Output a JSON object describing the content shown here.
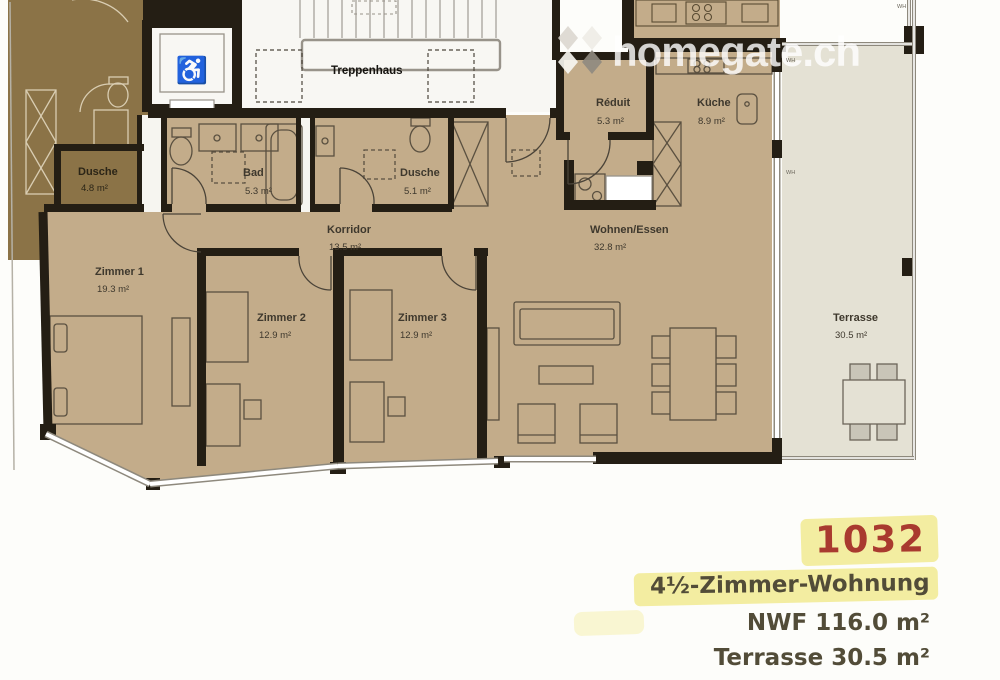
{
  "watermark": {
    "text": "homegate.ch",
    "icon": "homegate-diamond-logo"
  },
  "rooms": {
    "treppenhaus": {
      "name": "Treppenhaus"
    },
    "dusche_nachbar": {
      "name": "Dusche",
      "area": "4.8 m²"
    },
    "bad": {
      "name": "Bad",
      "area": "5.3 m²"
    },
    "dusche": {
      "name": "Dusche",
      "area": "5.1 m²"
    },
    "reduit": {
      "name": "Réduit",
      "area": "5.3 m²"
    },
    "kueche": {
      "name": "Küche",
      "area": "8.9 m²"
    },
    "korridor": {
      "name": "Korridor",
      "area": "13.5 m²"
    },
    "wohnen_essen": {
      "name": "Wohnen/Essen",
      "area": "32.8 m²"
    },
    "zimmer1": {
      "name": "Zimmer 1",
      "area": "19.3 m²"
    },
    "zimmer2": {
      "name": "Zimmer 2",
      "area": "12.9 m²"
    },
    "zimmer3": {
      "name": "Zimmer 3",
      "area": "12.9 m²"
    },
    "terrasse": {
      "name": "Terrasse",
      "area": "30.5 m²"
    }
  },
  "window_marks": {
    "wh": "WH"
  },
  "icons": {
    "wheelchair": "♿"
  },
  "annotation": {
    "unit": "1032",
    "type": "4½-Zimmer-Wohnung",
    "nwf": "NWF 116.0 m²",
    "terrace": "Terrasse 30.5 m²"
  },
  "colors": {
    "floor": "#c3ac8a",
    "neighbor": "#8b7347",
    "terrace": "#e4e1d4",
    "stairwell": "#f8f7f3",
    "wall": "#241e14",
    "furn": "#5a5040",
    "furn-light": "#d9cdb2",
    "gray": "#98938a",
    "label": "#3e382d",
    "label-olive": "#524c38",
    "highlight": "#f3eda1",
    "unit-red": "#a93a2f",
    "win": "#8e897d"
  }
}
